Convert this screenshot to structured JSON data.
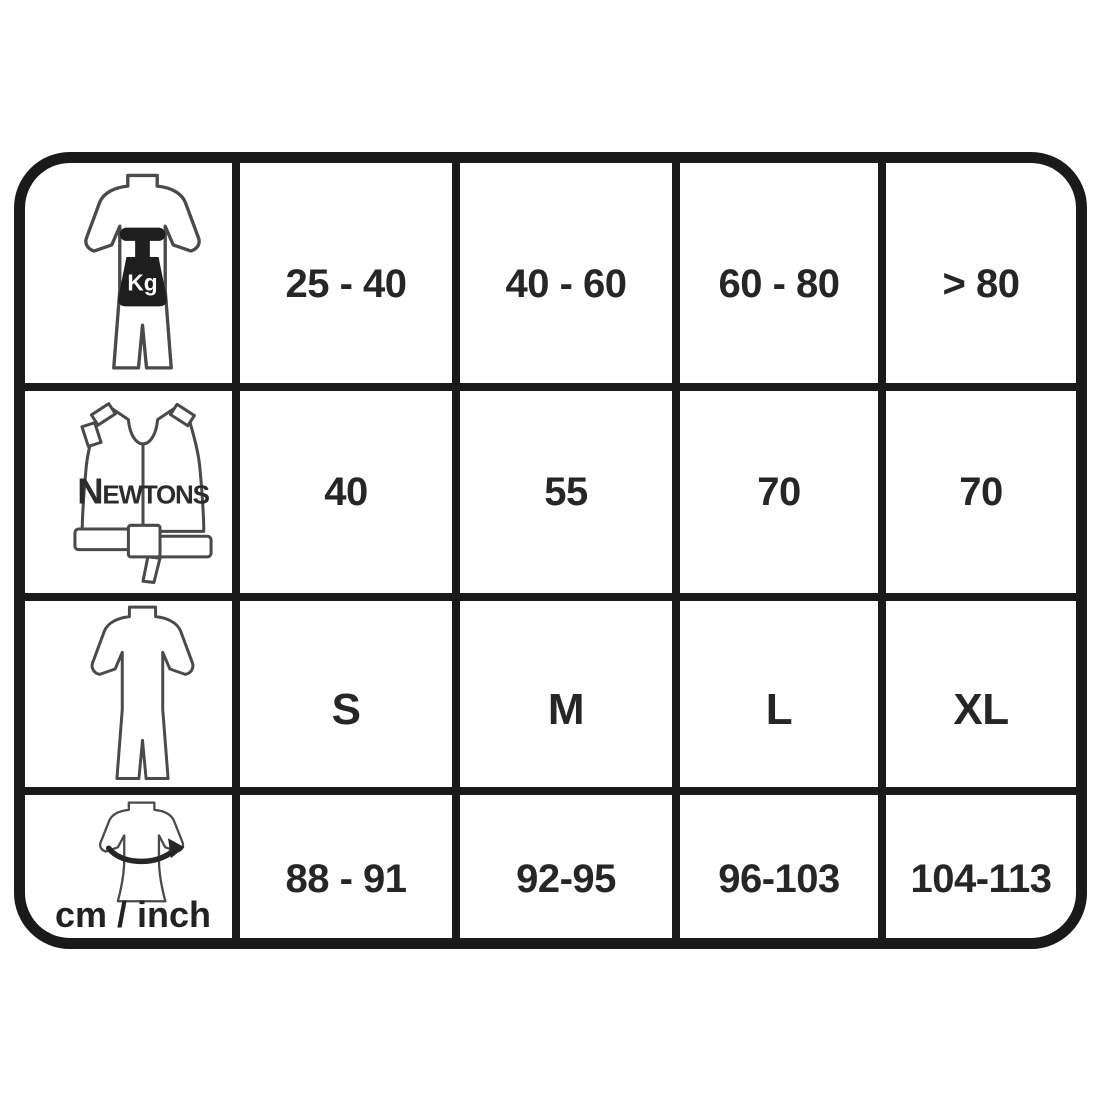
{
  "chart_data": {
    "type": "table",
    "title": "",
    "rows": [
      {
        "icon": "body-weight-kg-icon",
        "unit_label": "Kg",
        "values": [
          "25 - 40",
          "40 - 60",
          "60 - 80",
          "> 80"
        ]
      },
      {
        "icon": "buoyancy-vest-newtons-icon",
        "unit_label": "Newtons",
        "values": [
          "40",
          "55",
          "70",
          "70"
        ]
      },
      {
        "icon": "shorty-wetsuit-size-icon",
        "values": [
          "S",
          "M",
          "L",
          "XL"
        ]
      },
      {
        "icon": "chest-circumference-icon",
        "unit_label": "cm / inch",
        "values": [
          "88 - 91",
          "92-95",
          "96-103",
          "104-113"
        ]
      }
    ]
  },
  "colors": {
    "grid_line": "#1a1a1a",
    "cell_background": "#ffffff",
    "value_text": "#262626",
    "icon_outline": "#4a4a4a",
    "weight_fill": "#1e1e1e"
  }
}
